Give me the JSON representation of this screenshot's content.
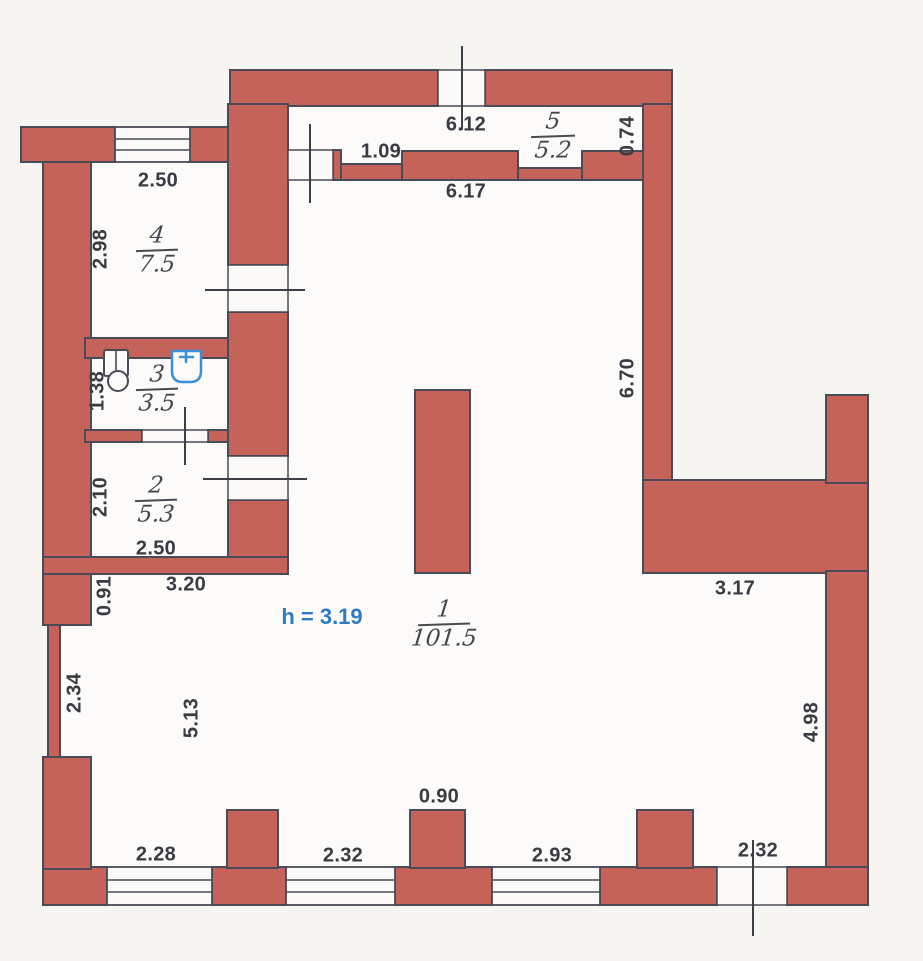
{
  "title": "apartment-floor-plan",
  "colors": {
    "wallFill": "#c5635a",
    "outline": "#4b4b57",
    "interior": "#fcfbf9",
    "paper": "#f6f5f2",
    "dimText": "#3a3a42",
    "heightText": "#2e7bc4",
    "sinkBlue": "#3b8fd6"
  },
  "rooms": {
    "r1": {
      "num": "1",
      "area": "101.5"
    },
    "r2": {
      "num": "2",
      "area": "5.3"
    },
    "r3": {
      "num": "3",
      "area": "3.5"
    },
    "r4": {
      "num": "4",
      "area": "7.5"
    },
    "r5": {
      "num": "5",
      "area": "5.2"
    }
  },
  "dims": {
    "topWindow": "6.12",
    "room5Step": "1.09",
    "room1Top": "6.17",
    "room5Right": "0.74",
    "room4Top": "2.50",
    "room4Left": "2.98",
    "room3Left": "1.38",
    "room2Left": "2.10",
    "room2Bottom": "2.50",
    "room1TopLeft": "3.20",
    "leftStep": "0.91",
    "leftMid": "2.34",
    "room1LeftSide": "5.13",
    "room1RightWall": "6.70",
    "room1RightExt": "3.17",
    "rightLowerWall": "4.98",
    "bottomWin1": "2.28",
    "bottomWin2": "2.32",
    "bottomPier": "0.90",
    "bottomWin3": "2.93",
    "bottomDoor": "2.32"
  },
  "notes": {
    "ceilingHeight": "h = 3.19"
  }
}
